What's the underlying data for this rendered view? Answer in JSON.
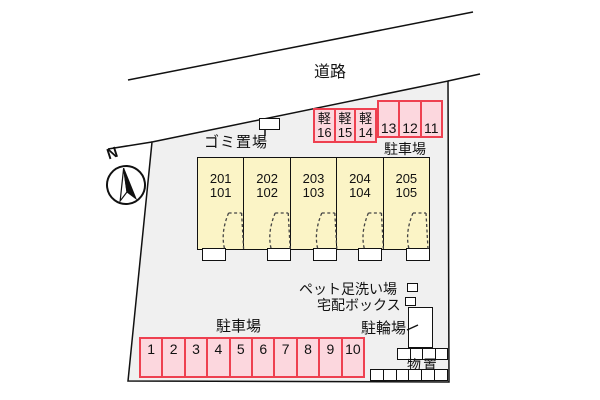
{
  "colors": {
    "plot_fill": "#f0f0f0",
    "building_fill": "#fbf4c6",
    "spot_fill": "#fcd7de",
    "spot_border": "#ee4050"
  },
  "compass": {
    "north_label": "N"
  },
  "road": {
    "label": "道路"
  },
  "garbage": {
    "label": "ゴミ置場"
  },
  "building": {
    "units": [
      {
        "upper": "201",
        "lower": "101"
      },
      {
        "upper": "202",
        "lower": "102"
      },
      {
        "upper": "203",
        "lower": "103"
      },
      {
        "upper": "204",
        "lower": "104"
      },
      {
        "upper": "205",
        "lower": "105"
      }
    ]
  },
  "parking_upper": {
    "label": "駐車場",
    "kei_spots": [
      {
        "type": "軽",
        "number": "16"
      },
      {
        "type": "軽",
        "number": "15"
      },
      {
        "type": "軽",
        "number": "14"
      }
    ],
    "spots": [
      "13",
      "12",
      "11"
    ]
  },
  "amenities": {
    "pet_wash_label": "ペット足洗い場",
    "delivery_box_label": "宅配ボックス",
    "bike_parking_label": "駐輪場",
    "storage_label": "物置"
  },
  "parking_lower": {
    "label": "駐車場",
    "spots": [
      "1",
      "2",
      "3",
      "4",
      "5",
      "6",
      "7",
      "8",
      "9",
      "10"
    ]
  }
}
